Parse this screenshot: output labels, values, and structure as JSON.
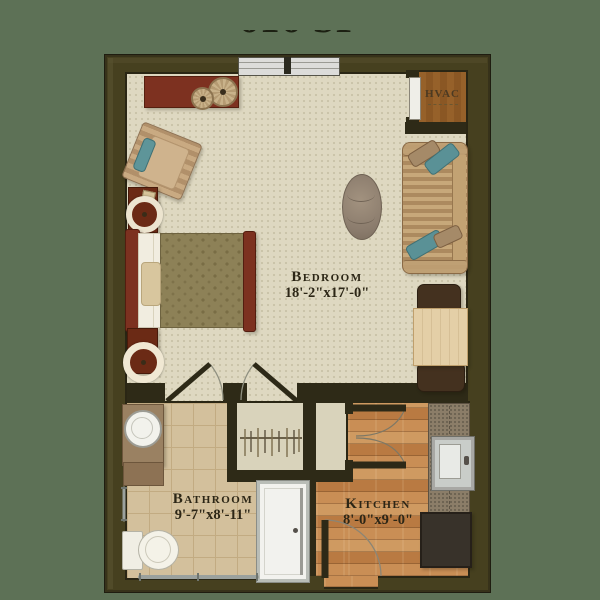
{
  "header": {
    "area_label": "616 SF"
  },
  "floor_plan": {
    "rooms": {
      "bedroom": {
        "name": "Bedroom",
        "dimensions": "18'-2\"x17'-0\""
      },
      "bathroom": {
        "name": "Bathroom",
        "dimensions": "9'-7\"x8'-11\""
      },
      "kitchen": {
        "name": "Kitchen",
        "dimensions": "8'-0\"x9'-0\""
      },
      "hvac_closet": {
        "name": "HVAC"
      }
    },
    "features": [
      "top-window",
      "entry-door",
      "bathroom-door",
      "bedroom-closet-door",
      "closet-hanger-rod",
      "pantry-double-doors",
      "grab-bar",
      "towel-bar",
      "hvac-door"
    ],
    "furniture": [
      "dresser",
      "potted-plant-large",
      "potted-plant-small",
      "armchair",
      "nightstand-top",
      "nightstand-bottom",
      "table-lamp-top",
      "table-lamp-bottom",
      "bed",
      "sofa",
      "accent-pillows",
      "ottoman",
      "dining-table",
      "dining-chairs",
      "kitchen-counter",
      "kitchen-sink",
      "range",
      "bathroom-vanity",
      "vanity-sink",
      "toilet",
      "shower"
    ],
    "colors": {
      "background_green": "#5d7156",
      "wall": "#46401f",
      "bedroom_floor": "#ded8c1",
      "bathroom_tile": "#d3c09c",
      "kitchen_wood": "#c08048",
      "furniture_red_brown": "#7c3120",
      "accent_teal": "#5a9196",
      "label_text": "#2c2616"
    }
  }
}
